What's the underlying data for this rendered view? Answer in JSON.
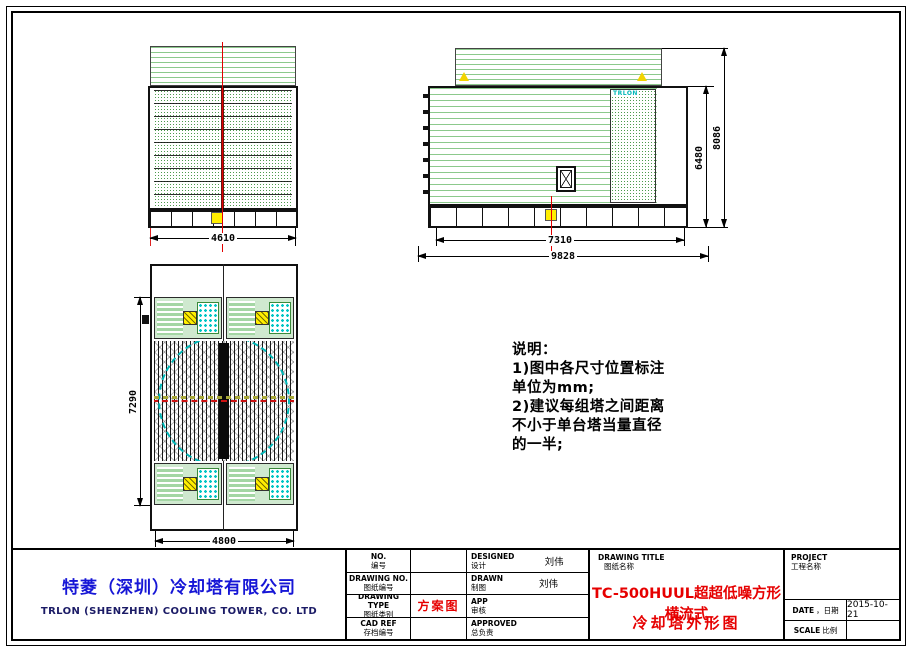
{
  "colors": {
    "green_line": "#8cc98c",
    "louver_green": "#4d9a4d",
    "cyan": "#00b7b7",
    "yellow": "#ffee00",
    "red": "#e60000",
    "company_blue": "#1616d6",
    "centerline_red": "#e30000"
  },
  "views": {
    "front": {
      "dim_width": "4610"
    },
    "side": {
      "dim_width": "7310",
      "dim_width_overall": "9828",
      "dim_height_casing": "6480",
      "dim_height_overall": "8086",
      "logo": "TRLON"
    },
    "plan": {
      "dim_length": "7290",
      "dim_width": "4800"
    }
  },
  "notes": {
    "lines": [
      "说明：",
      "1)图中各尺寸位置标注",
      "单位为mm;",
      "2)建议每组塔之间距离",
      "不小于单台塔当量直径",
      "的一半;"
    ]
  },
  "title_block": {
    "company": {
      "cn": "特菱（深圳）冷却塔有限公司",
      "en": "TRLON (SHENZHEN) COOLING TOWER, CO. LTD"
    },
    "rows": [
      {
        "en": "NO.",
        "cn": "编号",
        "value": ""
      },
      {
        "en": "DRAWING NO.",
        "cn": "图纸编号",
        "value": ""
      },
      {
        "en": "DRAWING TYPE",
        "cn": "图纸类别",
        "value": "方案图"
      },
      {
        "en": "CAD REF",
        "cn": "存档编号",
        "value": ""
      }
    ],
    "signs": [
      {
        "en": "DESIGNED",
        "cn": "设计",
        "name": "刘伟"
      },
      {
        "en": "DRAWN",
        "cn": "制图",
        "name": "刘伟"
      },
      {
        "en": "APP",
        "cn": "审核",
        "name": ""
      },
      {
        "en": "APPROVED",
        "cn": "总负责",
        "name": ""
      }
    ],
    "drawing_title": {
      "en": "DRAWING TITLE",
      "cn": "图纸名称",
      "line1": "TC-500HUUL超超低噪方形横流式",
      "line2": "冷却塔外形图"
    },
    "project": {
      "en": "PROJECT",
      "cn": "工程名称",
      "value": ""
    },
    "date": {
      "en": "DATE",
      "cn": "，日期",
      "value": "2015-10-21"
    },
    "scale": {
      "en": "SCALE",
      "cn": "比例",
      "value": ""
    }
  }
}
